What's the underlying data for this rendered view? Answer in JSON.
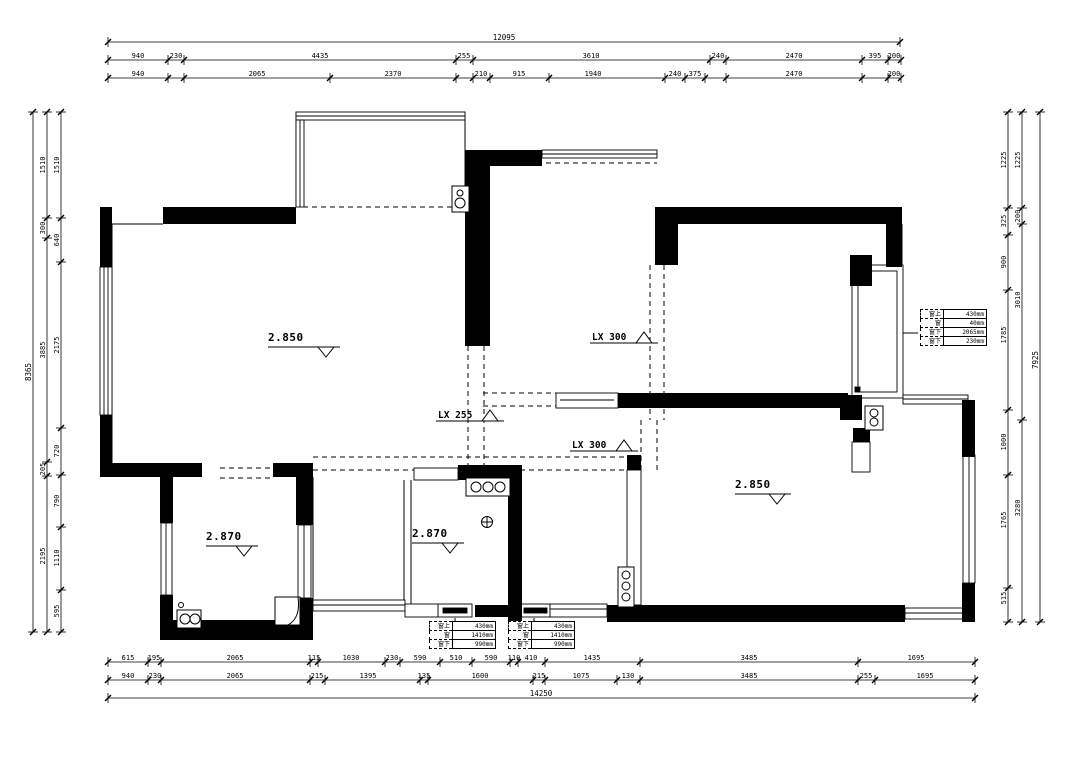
{
  "drawing": {
    "bg": "#ffffff",
    "line_color": "#000000"
  },
  "room_labels": [
    {
      "type": "level",
      "text": "2.850",
      "x": 268,
      "y": 341,
      "lw": 72
    },
    {
      "type": "level",
      "text": "2.870",
      "x": 206,
      "y": 540,
      "lw": 52
    },
    {
      "type": "level",
      "text": "2.870",
      "x": 412,
      "y": 537,
      "lw": 52
    },
    {
      "type": "level",
      "text": "2.850",
      "x": 735,
      "y": 488,
      "lw": 56
    },
    {
      "type": "lx",
      "text": "LX 300",
      "x": 592,
      "y": 340
    },
    {
      "type": "lx",
      "text": "LX 255",
      "x": 438,
      "y": 418
    },
    {
      "type": "lx",
      "text": "LX 300",
      "x": 572,
      "y": 448
    }
  ],
  "dim_chains": [
    {
      "dir": "h",
      "pos": 42,
      "from": 108,
      "to": 900,
      "ticks": [
        108,
        900
      ],
      "total": true,
      "labels": [
        {
          "t": "12095",
          "p": 504
        }
      ]
    },
    {
      "dir": "h",
      "pos": 60,
      "from": 108,
      "to": 901,
      "ticks": [
        108,
        168,
        184,
        456,
        473,
        710,
        726,
        862,
        888,
        901
      ],
      "labels": [
        {
          "t": "940",
          "p": 138
        },
        {
          "t": "230",
          "p": 176
        },
        {
          "t": "4435",
          "p": 320
        },
        {
          "t": "255",
          "p": 464
        },
        {
          "t": "3610",
          "p": 591
        },
        {
          "t": "240",
          "p": 718
        },
        {
          "t": "2470",
          "p": 794
        },
        {
          "t": "395",
          "p": 875
        },
        {
          "t": "200",
          "p": 894
        }
      ]
    },
    {
      "dir": "h",
      "pos": 78,
      "from": 108,
      "to": 901,
      "ticks": [
        108,
        168,
        184,
        330,
        456,
        473,
        490,
        549,
        665,
        685,
        705,
        726,
        862,
        888,
        901
      ],
      "labels": [
        {
          "t": "940",
          "p": 138
        },
        {
          "t": "2065",
          "p": 257
        },
        {
          "t": "2370",
          "p": 393
        },
        {
          "t": "210",
          "p": 481
        },
        {
          "t": "915",
          "p": 519
        },
        {
          "t": "1940",
          "p": 593
        },
        {
          "t": "240",
          "p": 675
        },
        {
          "t": "375",
          "p": 695
        },
        {
          "t": "2470",
          "p": 794
        },
        {
          "t": "200",
          "p": 894
        }
      ]
    },
    {
      "dir": "h",
      "pos": 662,
      "from": 108,
      "to": 975,
      "ticks": [
        108,
        148,
        161,
        310,
        318,
        385,
        400,
        440,
        472,
        510,
        518,
        545,
        640,
        858,
        975
      ],
      "labels": [
        {
          "t": "615",
          "p": 128
        },
        {
          "t": "195",
          "p": 154
        },
        {
          "t": "2065",
          "p": 235
        },
        {
          "t": "115",
          "p": 314
        },
        {
          "t": "1030",
          "p": 351
        },
        {
          "t": "230",
          "p": 392
        },
        {
          "t": "590",
          "p": 420
        },
        {
          "t": "510",
          "p": 456
        },
        {
          "t": "590",
          "p": 491
        },
        {
          "t": "110",
          "p": 514
        },
        {
          "t": "410",
          "p": 531
        },
        {
          "t": "1435",
          "p": 592
        },
        {
          "t": "3485",
          "p": 749
        },
        {
          "t": "1695",
          "p": 916
        }
      ]
    },
    {
      "dir": "h",
      "pos": 680,
      "from": 108,
      "to": 975,
      "ticks": [
        108,
        148,
        161,
        310,
        325,
        420,
        428,
        533,
        545,
        617,
        640,
        858,
        875,
        975
      ],
      "labels": [
        {
          "t": "940",
          "p": 128
        },
        {
          "t": "230",
          "p": 155
        },
        {
          "t": "2065",
          "p": 235
        },
        {
          "t": "215",
          "p": 317
        },
        {
          "t": "1395",
          "p": 368
        },
        {
          "t": "135",
          "p": 424
        },
        {
          "t": "1600",
          "p": 480
        },
        {
          "t": "215",
          "p": 539
        },
        {
          "t": "1075",
          "p": 581
        },
        {
          "t": "130",
          "p": 628
        },
        {
          "t": "3485",
          "p": 749
        },
        {
          "t": "255",
          "p": 866
        },
        {
          "t": "1695",
          "p": 925
        }
      ]
    },
    {
      "dir": "h",
      "pos": 698,
      "from": 108,
      "to": 975,
      "ticks": [
        108,
        975
      ],
      "total": true,
      "labels": [
        {
          "t": "14250",
          "p": 541
        }
      ]
    },
    {
      "dir": "v",
      "pos": 47,
      "from": 112,
      "to": 632,
      "ticks": [
        112,
        218,
        238,
        462,
        476,
        632
      ],
      "labels": [
        {
          "t": "1510",
          "p": 165
        },
        {
          "t": "300",
          "p": 228
        },
        {
          "t": "3885",
          "p": 350
        },
        {
          "t": "205",
          "p": 469
        },
        {
          "t": "2195",
          "p": 556
        }
      ]
    },
    {
      "dir": "v",
      "pos": 61,
      "from": 112,
      "to": 632,
      "ticks": [
        112,
        218,
        262,
        428,
        475,
        527,
        590,
        632
      ],
      "labels": [
        {
          "t": "1510",
          "p": 165
        },
        {
          "t": "640",
          "p": 240
        },
        {
          "t": "2175",
          "p": 345
        },
        {
          "t": "720",
          "p": 451
        },
        {
          "t": "790",
          "p": 501
        },
        {
          "t": "1110",
          "p": 558
        },
        {
          "t": "595",
          "p": 611
        }
      ]
    },
    {
      "dir": "v",
      "pos": 33,
      "from": 112,
      "to": 632,
      "ticks": [
        112,
        632
      ],
      "total": true,
      "labels": [
        {
          "t": "8365",
          "p": 372
        }
      ]
    },
    {
      "dir": "v",
      "pos": 1008,
      "from": 112,
      "to": 622,
      "ticks": [
        112,
        208,
        235,
        290,
        410,
        475,
        588,
        622
      ],
      "labels": [
        {
          "t": "1225",
          "p": 160
        },
        {
          "t": "325",
          "p": 221
        },
        {
          "t": "900",
          "p": 262
        },
        {
          "t": "1785",
          "p": 335
        },
        {
          "t": "1000",
          "p": 442
        },
        {
          "t": "1765",
          "p": 520
        },
        {
          "t": "515",
          "p": 598
        }
      ]
    },
    {
      "dir": "v",
      "pos": 1022,
      "from": 112,
      "to": 622,
      "ticks": [
        112,
        208,
        224,
        420,
        622
      ],
      "labels": [
        {
          "t": "1225",
          "p": 160
        },
        {
          "t": "200",
          "p": 216
        },
        {
          "t": "3010",
          "p": 300
        },
        {
          "t": "3280",
          "p": 508
        }
      ]
    },
    {
      "dir": "v",
      "pos": 1040,
      "from": 112,
      "to": 622,
      "ticks": [
        112,
        622
      ],
      "total": true,
      "labels": [
        {
          "t": "7925",
          "p": 360
        }
      ]
    }
  ],
  "tables": [
    {
      "x": 920,
      "y": 309,
      "rows": [
        [
          "窗上",
          "430mm"
        ],
        [
          "窗",
          "40mm"
        ],
        [
          "窗下",
          "2065mm"
        ],
        [
          "窗下",
          "230mm"
        ]
      ]
    },
    {
      "x": 429,
      "y": 621,
      "rows": [
        [
          "窗上",
          "430mm"
        ],
        [
          "窗",
          "1410mm"
        ],
        [
          "窗下",
          "990mm"
        ]
      ]
    },
    {
      "x": 508,
      "y": 621,
      "rows": [
        [
          "窗上",
          "430mm"
        ],
        [
          "窗",
          "1410mm"
        ],
        [
          "窗下",
          "990mm"
        ]
      ]
    }
  ]
}
